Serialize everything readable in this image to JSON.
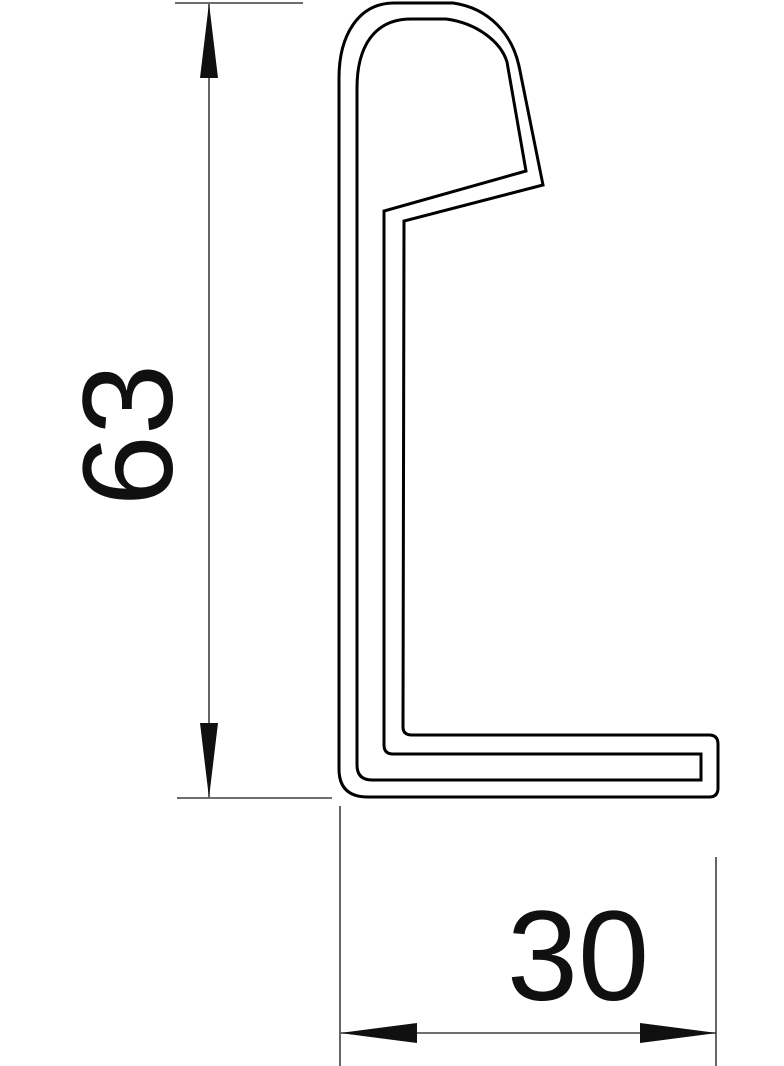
{
  "drawing": {
    "kind": "profile-cross-section-technical-drawing",
    "background_color": "#ffffff",
    "profile_line_color": "#000000",
    "dimension_line_color": "#3f3f3f",
    "text_color": "#101010",
    "dimensions": {
      "height": {
        "value": "63",
        "orientation": "vertical"
      },
      "width": {
        "value": "30",
        "orientation": "horizontal"
      }
    }
  }
}
